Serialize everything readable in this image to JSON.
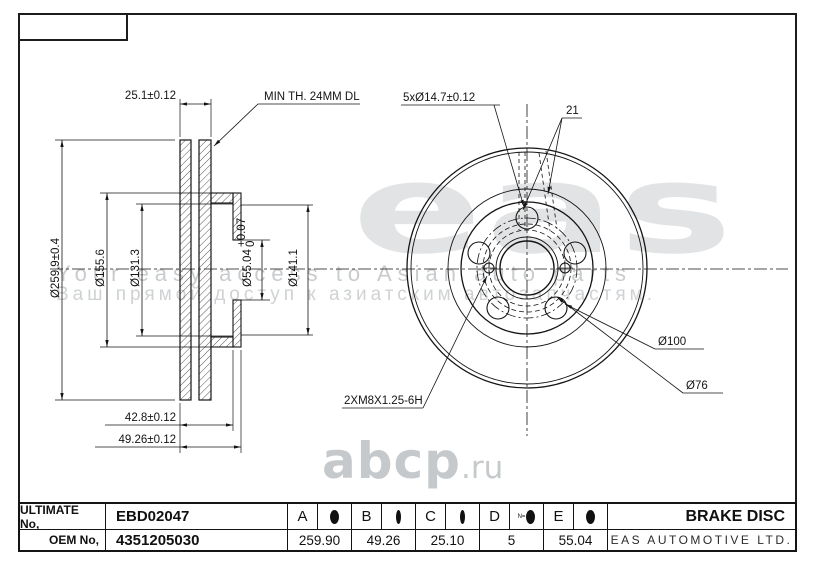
{
  "watermark": {
    "logo_text": "eas",
    "tagline_en": "Your easy access to Asian auto parts",
    "tagline_ru": "Ваш прямой доступ к азиатским автозапчастям.",
    "site_name": "abcp",
    "site_tld": ".ru"
  },
  "drawing": {
    "section_view": {
      "thickness": "25.1±0.12",
      "min_thickness_note": "MIN TH. 24MM DL",
      "outer_diameter": "Ø259.9±0.4",
      "diameter_155": "Ø155.6",
      "diameter_131": "Ø131.3",
      "bore_diameter": "Ø55.04",
      "bore_tolerance_upper": "+0.07",
      "bore_tolerance_lower": "0",
      "diameter_141": "Ø141.1",
      "hat_depth": "42.8±0.12",
      "total_height": "49.26±0.12"
    },
    "front_view": {
      "bolt_hole_spec": "5xØ14.7±0.12",
      "callout_21": "21",
      "thread_spec": "2XM8X1.25-6H",
      "bolt_circle_diameter": "Ø100",
      "diameter_76": "Ø76"
    }
  },
  "title_block": {
    "ultimate_no_label": "ULTIMATE No,",
    "ultimate_no_value": "EBD02047",
    "oem_no_label": "OEM No,",
    "oem_no_value": "4351205030",
    "columns": [
      {
        "letter": "A",
        "icon": "outer-diameter-icon",
        "value": "259.90"
      },
      {
        "letter": "B",
        "icon": "height-icon",
        "value": "49.26"
      },
      {
        "letter": "C",
        "icon": "thickness-icon",
        "value": "25.10"
      },
      {
        "letter": "D",
        "icon": "holes-count-icon",
        "icon_label": "N=",
        "value": "5"
      },
      {
        "letter": "E",
        "icon": "bore-diameter-icon",
        "value": "55.04"
      }
    ],
    "product_name": "BRAKE DISC",
    "company_name": "EAS AUTOMOTIVE LTD."
  }
}
